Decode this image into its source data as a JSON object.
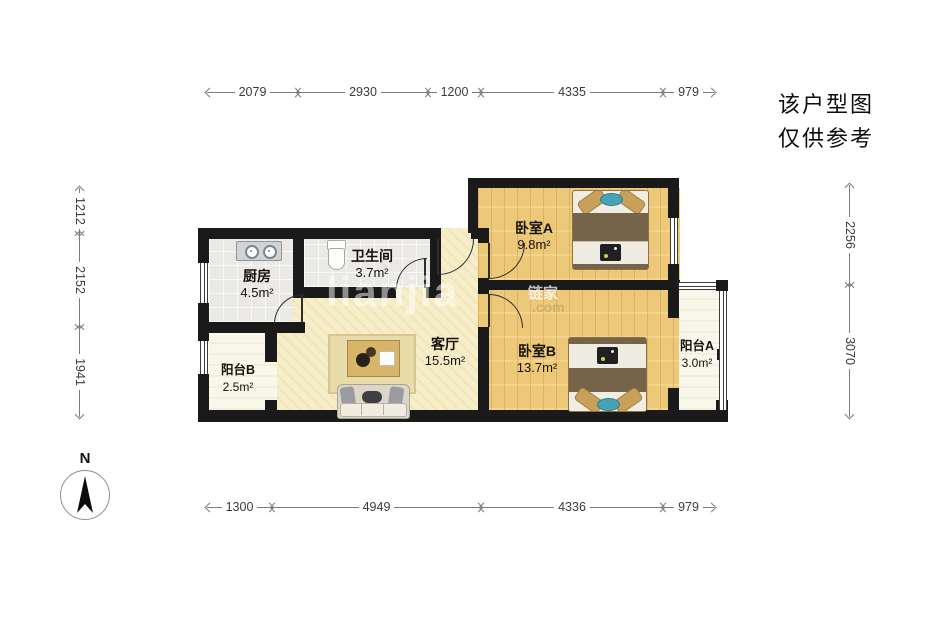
{
  "notice": {
    "line1": "该户型图",
    "line2": "仅供参考"
  },
  "compass": {
    "label": "N"
  },
  "watermark": {
    "wordmark": "lianjia",
    "cn": "链家",
    "domain": ".com"
  },
  "dims": {
    "top": [
      "2079",
      "2930",
      "1200",
      "4335",
      "979"
    ],
    "bottom": [
      "1300",
      "4949",
      "4336",
      "979"
    ],
    "left": [
      "1212",
      "2152",
      "1941"
    ],
    "right": [
      "2256",
      "3070"
    ]
  },
  "rooms": {
    "kitchen": {
      "name": "厨房",
      "area": "4.5m²"
    },
    "bathroom": {
      "name": "卫生间",
      "area": "3.7m²"
    },
    "living": {
      "name": "客厅",
      "area": "15.5m²"
    },
    "bedroomA": {
      "name": "卧室A",
      "area": "9.8m²"
    },
    "bedroomB": {
      "name": "卧室B",
      "area": "13.7m²"
    },
    "balconyA": {
      "name": "阳台A",
      "area": "3.0m²"
    },
    "balconyB": {
      "name": "阳台B",
      "area": "2.5m²"
    }
  },
  "colors": {
    "wall": "#1a1a1a",
    "wood_floor": "#ecc878",
    "living_floor": "#f6eec9",
    "tile_floor": "#eae9e6",
    "balcony_floor": "#f9f6ea",
    "accent_teal": "#46a3b5"
  }
}
